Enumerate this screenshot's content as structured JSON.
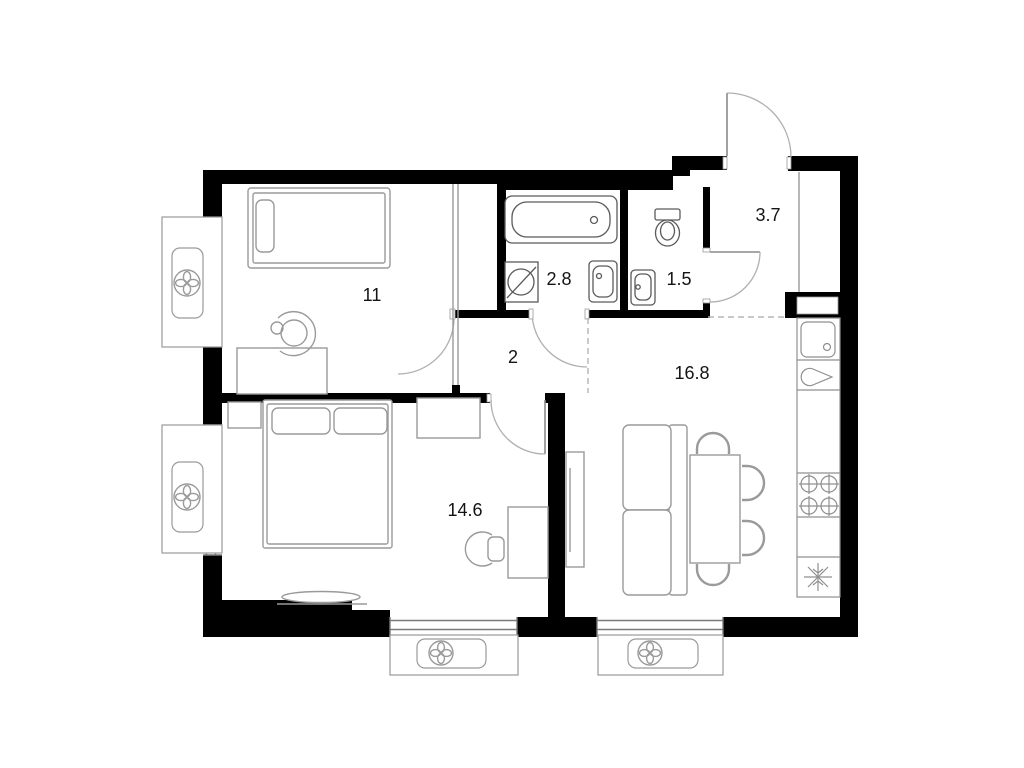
{
  "plan": {
    "title": "two-room apartment floor plan",
    "rooms": [
      {
        "id": "bedroom-1",
        "name": "bedroom",
        "area_label": "11"
      },
      {
        "id": "bathroom",
        "name": "bathroom",
        "area_label": "2.8"
      },
      {
        "id": "toilet",
        "name": "toilet",
        "area_label": "1.5"
      },
      {
        "id": "hallway",
        "name": "entrance hall",
        "area_label": "3.7"
      },
      {
        "id": "corridor",
        "name": "corridor",
        "area_label": "2"
      },
      {
        "id": "kitchen-living",
        "name": "kitchen-living room",
        "area_label": "16.8"
      },
      {
        "id": "bedroom-2",
        "name": "bedroom",
        "area_label": "14.6"
      }
    ],
    "colors": {
      "wall": "#000000",
      "fixture_stroke": "#5a5a5a",
      "furniture_stroke": "#9a9a9a",
      "door_arc": "#b0b0b0",
      "background": "#ffffff"
    },
    "icons": {
      "ventilation-fan-icon": "four-petal fan in circle",
      "washing-machine-icon": "circle with diagonal slash",
      "stove-burners-icon": "four crossed burner circles",
      "fridge-snowflake-icon": "snowflake asterisk",
      "sink-drain-icon": "small circle dot"
    }
  }
}
